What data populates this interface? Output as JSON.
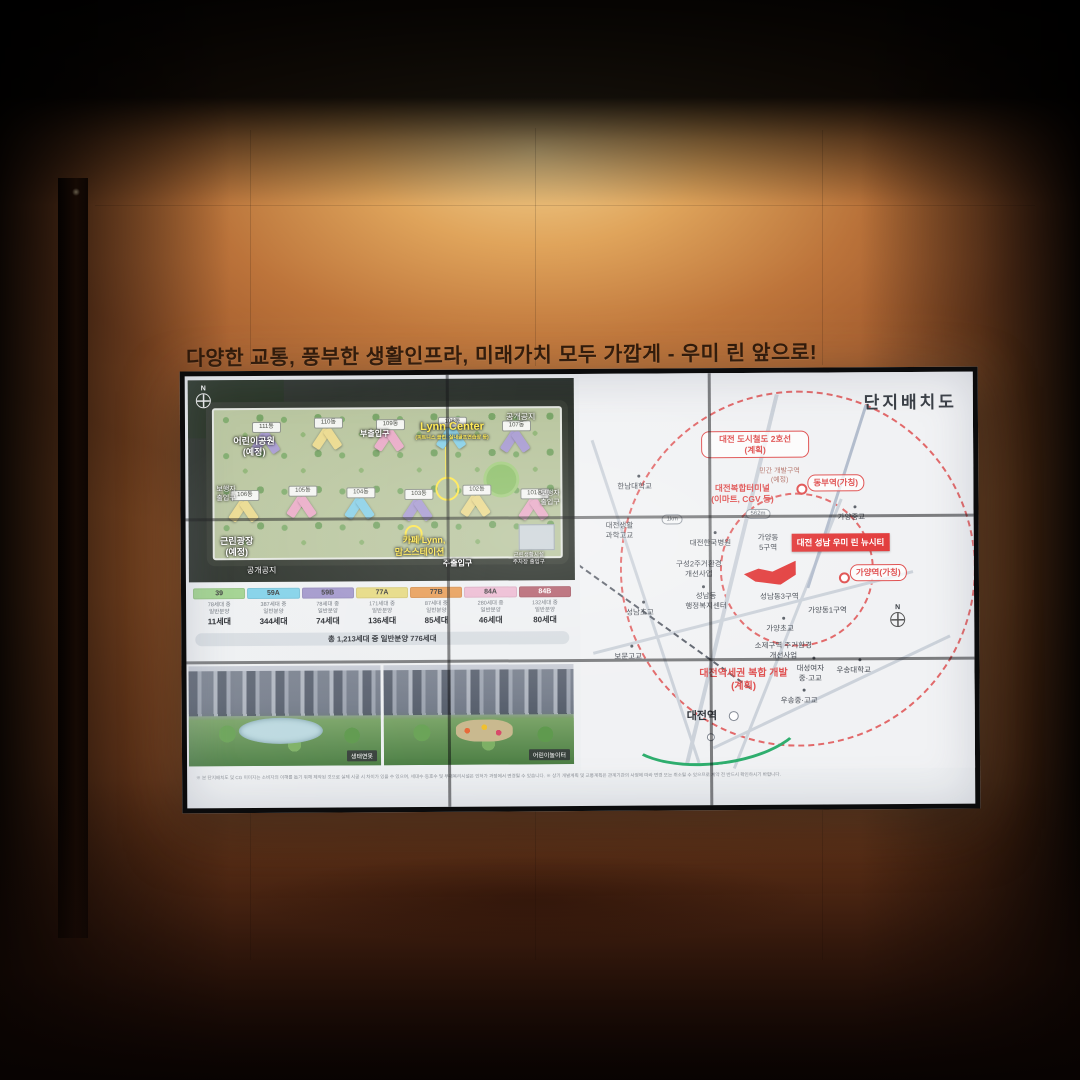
{
  "scene": {
    "headline": "다양한 교통, 풍부한 생활인프라, 미래가치 모두 가깝게 - 우미 린 앞으로!"
  },
  "colors": {
    "brand_red": "#e23b3b",
    "map_red": "#e05252",
    "highlight_yellow": "#ffe84a"
  },
  "plan": {
    "compass": "N",
    "labels": {
      "children_park": "어린이공원\n(예정)",
      "sub_gate": "부출입구",
      "lynn_center": "Lynn Center",
      "lynn_center_sub": "(피트니스 클럽, 실내골프연습장 등)",
      "open_space_top": "공개공지",
      "ped_gate_left": "보행자\n출입구",
      "ped_gate_right": "보행자\n출입구",
      "plaza": "근린광장\n(예정)",
      "open_space_bottom": "공개공지",
      "cafe_lynn": "카페 Lynn,",
      "moms_station": "맘스스테이션",
      "main_gate": "주출입구",
      "parking_gate": "근린생활시설\n주차장 출입구"
    },
    "buildings_top": [
      "111동",
      "110동",
      "109동",
      "108동",
      "107동"
    ],
    "buildings_bottom": [
      "106동",
      "105동",
      "104동",
      "103동",
      "102동",
      "101동"
    ]
  },
  "unit_table": {
    "columns": [
      {
        "code": "39",
        "color": "#9ed18b",
        "total": "78세대 중",
        "sale": "일반분양",
        "units": "11세대"
      },
      {
        "code": "59A",
        "color": "#7ed0e8",
        "total": "387세대 중",
        "sale": "일반분양",
        "units": "344세대"
      },
      {
        "code": "59B",
        "color": "#9e93c9",
        "total": "78세대 중",
        "sale": "일반분양",
        "units": "74세대"
      },
      {
        "code": "77A",
        "color": "#e5d87d",
        "total": "171세대 중",
        "sale": "일반분양",
        "units": "136세대"
      },
      {
        "code": "77B",
        "color": "#e79a52",
        "total": "87세대 중",
        "sale": "일반분양",
        "units": "85세대"
      },
      {
        "code": "84A",
        "color": "#ecb9d1",
        "total": "280세대 중",
        "sale": "일반분양",
        "units": "46세대"
      },
      {
        "code": "84B",
        "color": "#b4616e",
        "total": "132세대 중",
        "sale": "일반분양",
        "units": "80세대"
      }
    ],
    "total_row": "총 1,213세대 중 일반분양 776세대"
  },
  "photos": [
    {
      "caption": "생태연못"
    },
    {
      "caption": "어린이놀이터"
    }
  ],
  "map": {
    "title": "단지배치도",
    "boxes": {
      "metro_line2": "대전 도시철도 2호선\n(계획)",
      "dongbu_station": "동부역(가칭)",
      "gayang_station": "가양역(가칭)",
      "project": "대전 성남 우미 린 뉴시티"
    },
    "red_labels": {
      "terminal": "대전복합터미널\n(이마트, CGV 등)",
      "station_dev": "대전역세권 복합 개발\n(계획)"
    },
    "labels": {
      "hannam_univ": "한남대학교",
      "private_dev": "민간 개발구역\n(예정)",
      "gayang_middle": "가양중교",
      "dist_1km": "1km",
      "dist_562m": "562m",
      "life_science_hs": "대전생활\n과학고교",
      "korea_hospital": "대전한국병원",
      "gayang5": "가양동\n5구역",
      "guseong2": "구성2주거환경\n개선사업",
      "seongnam_center": "성남동\n행정복지센터",
      "seongnam3": "성남동3구역",
      "gayang1": "가양동1구역",
      "seongnam_elem": "성남초교",
      "gayang_elem": "가양초교",
      "soje": "소제구역 주거환경\n개선사업",
      "bomun_hs": "보문고교",
      "daeseong_girls": "대성여자\n중·고교",
      "woosong_univ": "우송대학교",
      "woosong_mid_hs": "우송중·고교",
      "daejeon_station": "대전역",
      "compass": "N"
    }
  },
  "disclaimer": "※ 본 단지배치도 및 CG 이미지는 소비자의 이해를 돕기 위해 제작된 것으로 실제 시공 시 차이가 있을 수 있으며, 세대수·동호수 및 부대복리시설은 인허가 과정에서 변경될 수 있습니다.  ※ 상기 개발계획 및 교통계획은 관계기관의 사정에 따라 변경 또는 취소될 수 있으므로 계약 전 반드시 확인하시기 바랍니다."
}
